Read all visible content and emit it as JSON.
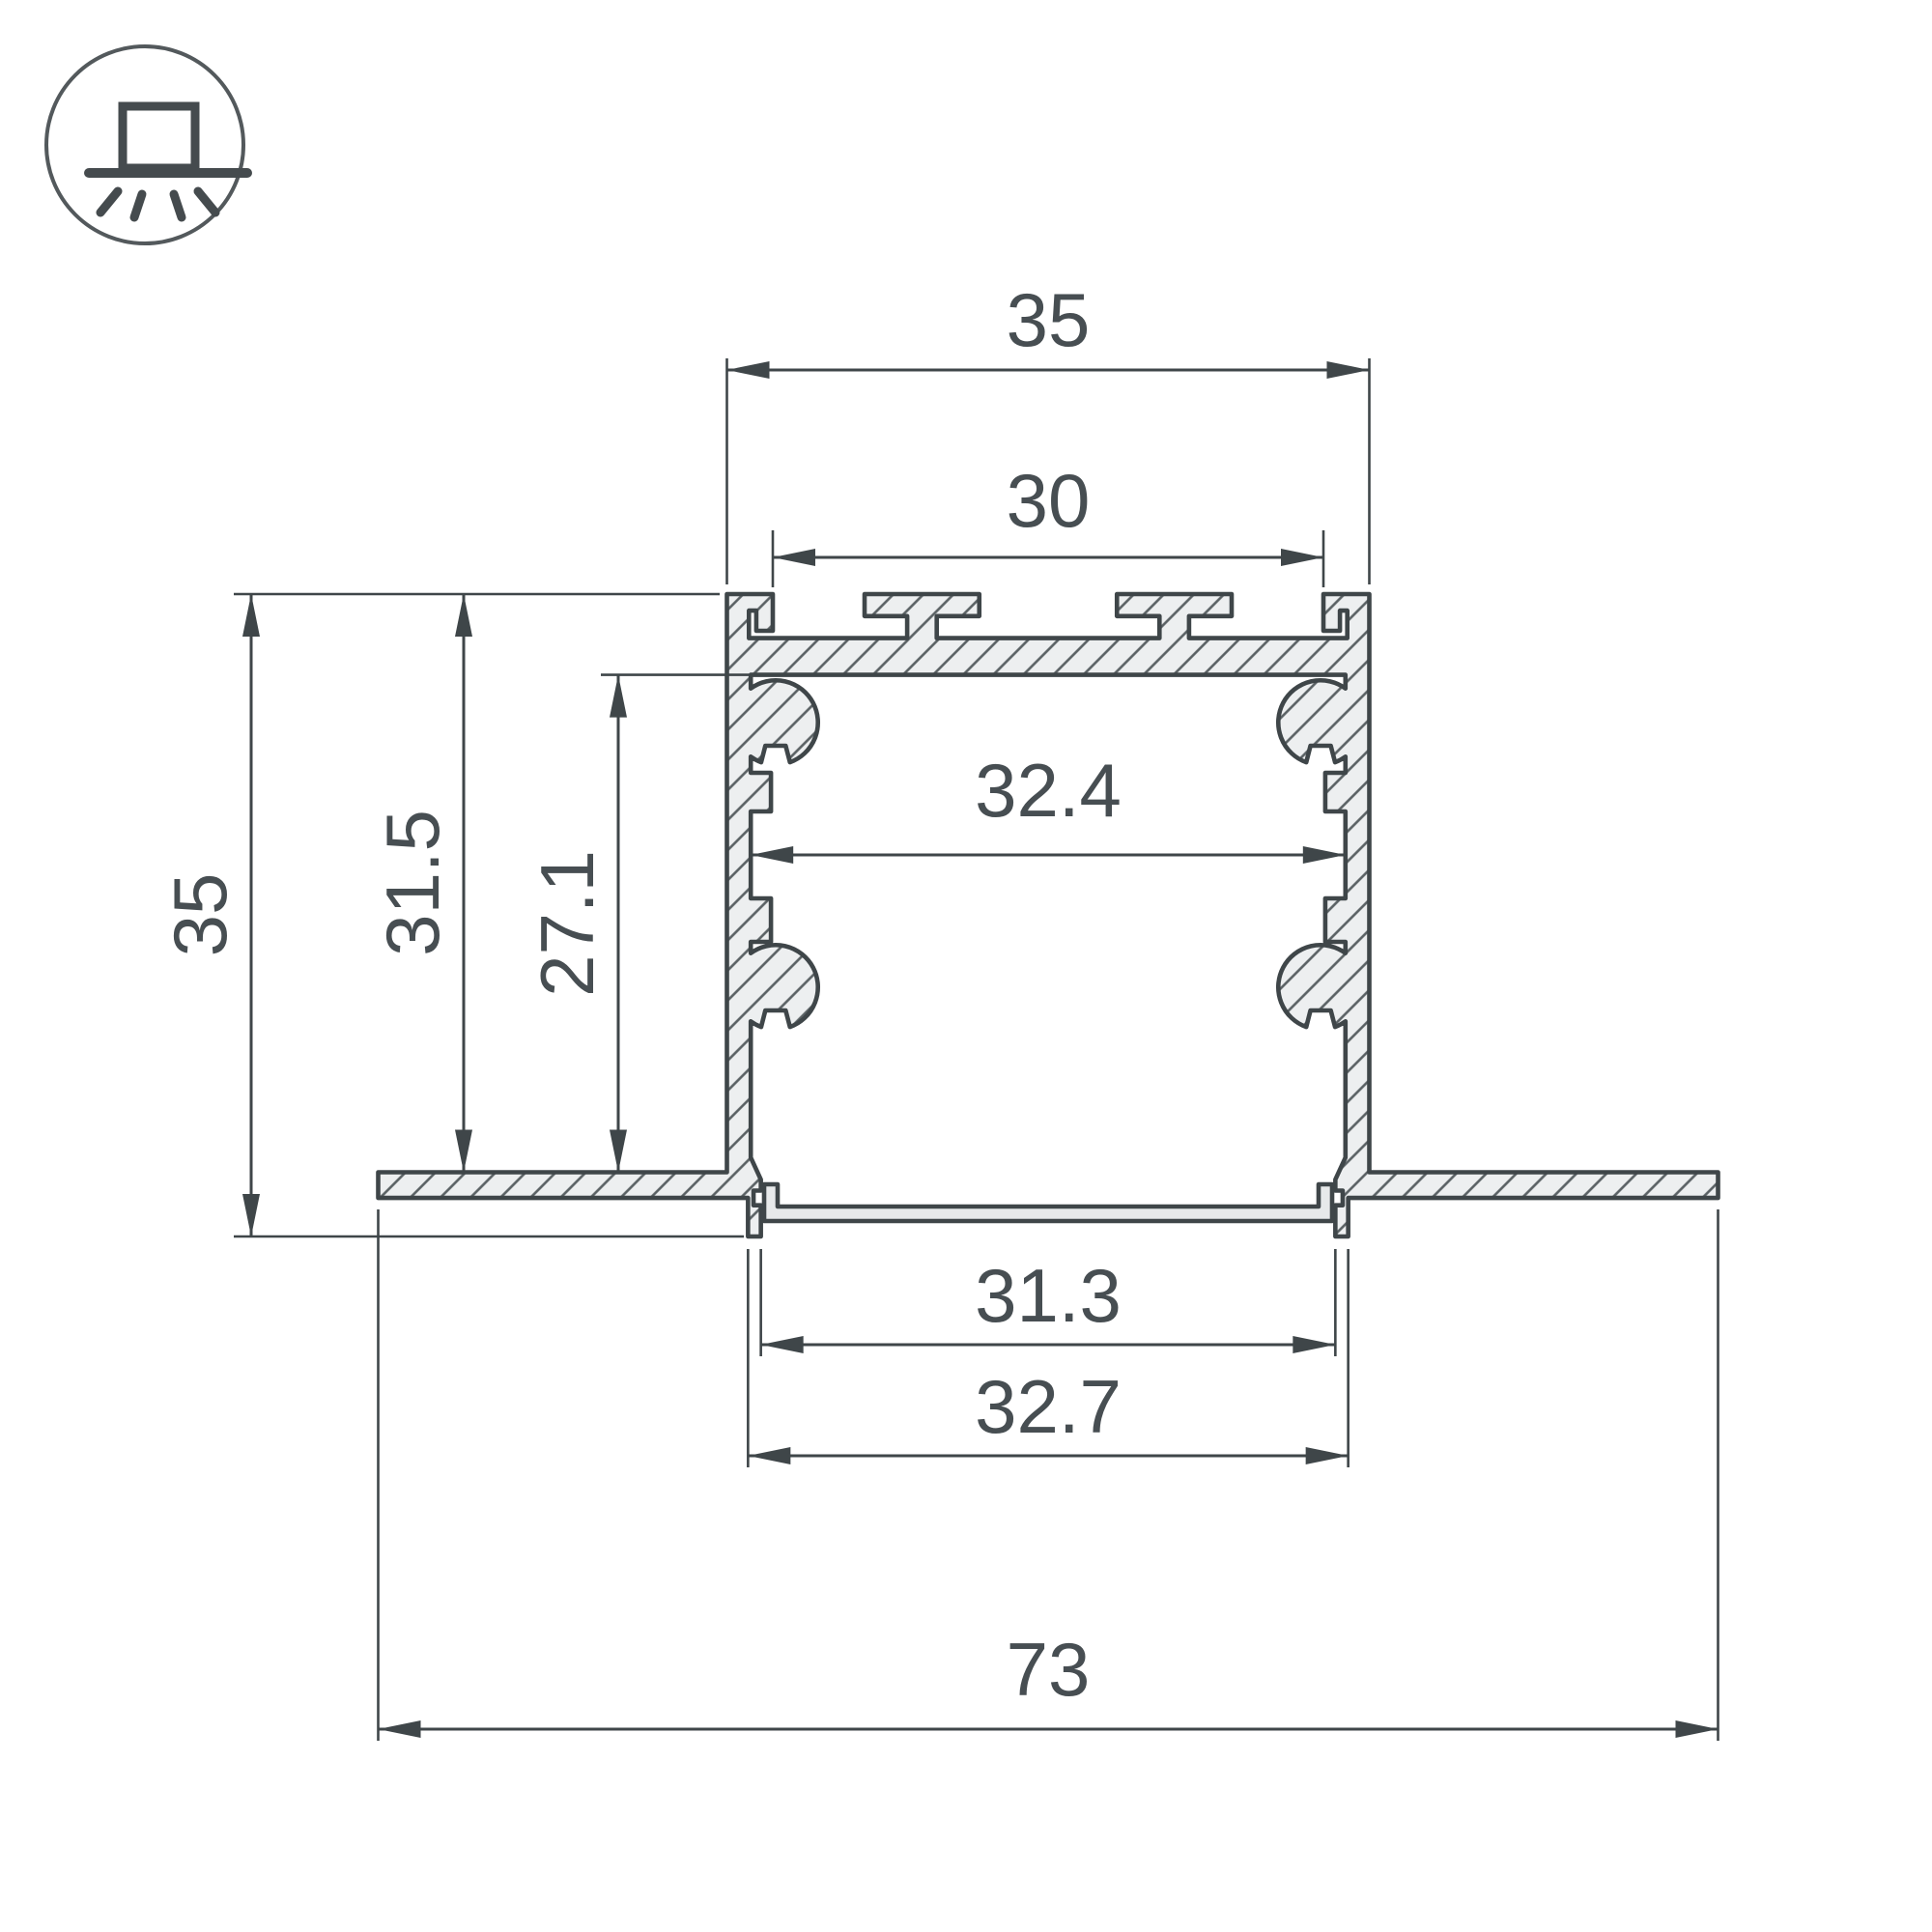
{
  "drawing": {
    "title": "recessed-led-profile-cross-section",
    "units": "mm",
    "dimensions": {
      "outer_top_width": "35",
      "groove_span": "30",
      "inner_width": "32.4",
      "overall_height": "35",
      "recess_depth": "31.5",
      "cavity_height": "27.1",
      "bottom_opening_width": "31.3",
      "bottom_outer_width": "32.7",
      "overall_flange_width": "73"
    },
    "icon": "recessed-mount-light-icon",
    "colors": {
      "line": "#3f4649",
      "text": "#474e52",
      "aluminum_fill": "#edeff0",
      "hatch": "#5a6164",
      "background": "#ffffff"
    }
  }
}
